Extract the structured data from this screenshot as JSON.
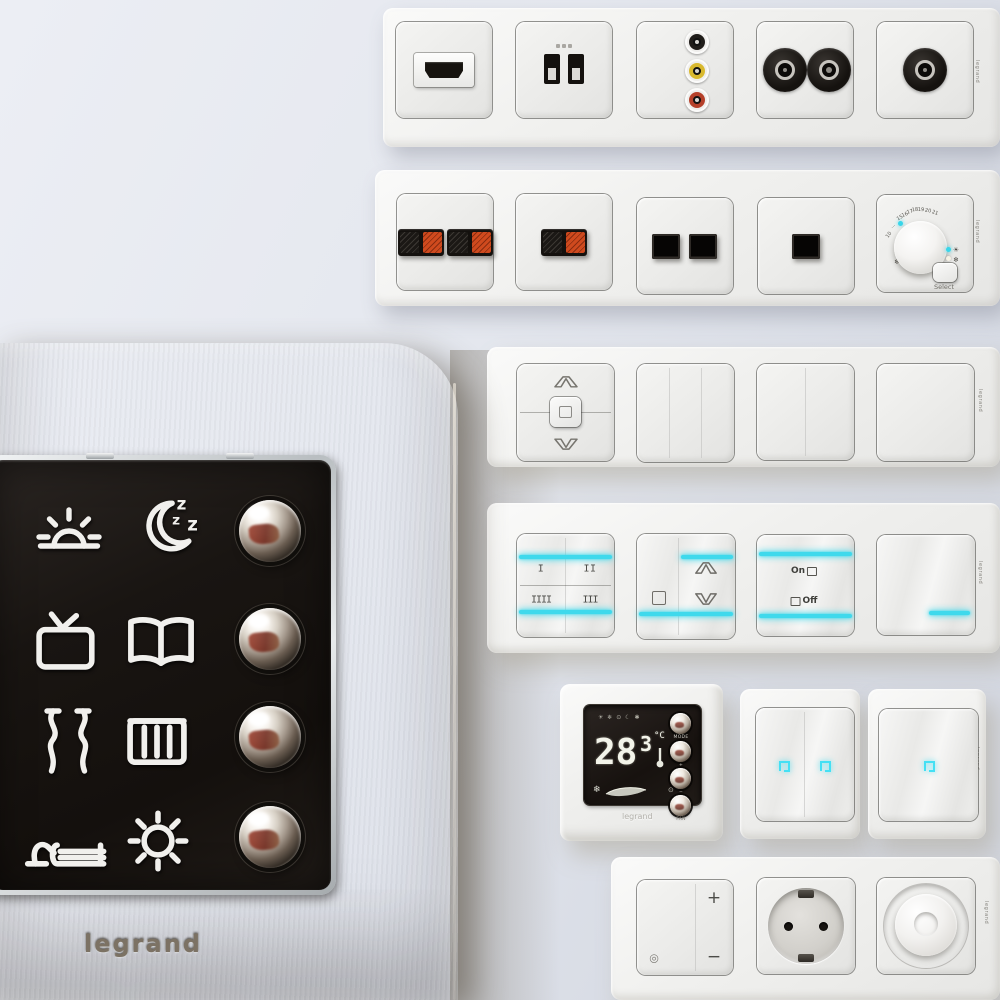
{
  "brand": "legrand",
  "colors": {
    "accent_cyan": "#3fd9ec",
    "terminal_red": "#cf4a1e",
    "rca_yellow": "#d9b92e",
    "rca_red": "#b5402a",
    "metal_bronze": "#978c7d",
    "glass_black": "#17120f"
  },
  "rows": [
    {
      "name": "av-sockets",
      "modules": [
        "hdmi",
        "usb-double",
        "rca-triple",
        "tv-sat-double",
        "coax-single"
      ]
    },
    {
      "name": "media-sockets",
      "modules": [
        "speaker-double",
        "speaker-single",
        "rj45-double",
        "rj45-single",
        "thermostat-dial"
      ]
    },
    {
      "name": "rockers",
      "modules": [
        "blind-rocker",
        "rocker-3gang",
        "rocker-2gang",
        "rocker-blank"
      ]
    },
    {
      "name": "touch-switches",
      "modules": [
        "scene-touch",
        "blind-touch",
        "onoff-touch",
        "blank-touch"
      ]
    },
    {
      "name": "thermostat-and-touch",
      "modules": [
        "digital-thermostat",
        "touch-2gang",
        "touch-1gang"
      ]
    },
    {
      "name": "power",
      "modules": [
        "dimmer-rocker",
        "schuko-socket",
        "rotary-dimmer"
      ]
    }
  ],
  "dial": {
    "scale": [
      "10",
      "...",
      "15",
      "16",
      "17",
      "18",
      "19",
      "20",
      "21"
    ],
    "select_label": "Select",
    "snow_glyph": "❄",
    "sun_glyph": "☀"
  },
  "scene_touch": {
    "labels": [
      "I",
      "II",
      "IIII",
      "III"
    ]
  },
  "onoff": {
    "on_label": "On",
    "off_label": "Off"
  },
  "thermostat": {
    "temp": "28",
    "decimal": "3",
    "unit": "°C",
    "mode_icons": "☀ ❄ ⊙ ☾ ✱",
    "snow_glyph": "❄",
    "fan_dots": "⊙ ◦",
    "buttons": [
      "MODE",
      "+",
      "−",
      "FAN"
    ]
  },
  "dimmer": {
    "plus": "+",
    "minus": "−",
    "indicator_glyph": "◎"
  },
  "scene_panel": {
    "icons": [
      "sunrise",
      "sleep",
      "tv",
      "reading",
      "curtains",
      "heating",
      "relax",
      "brightness"
    ],
    "button_count": 4
  }
}
